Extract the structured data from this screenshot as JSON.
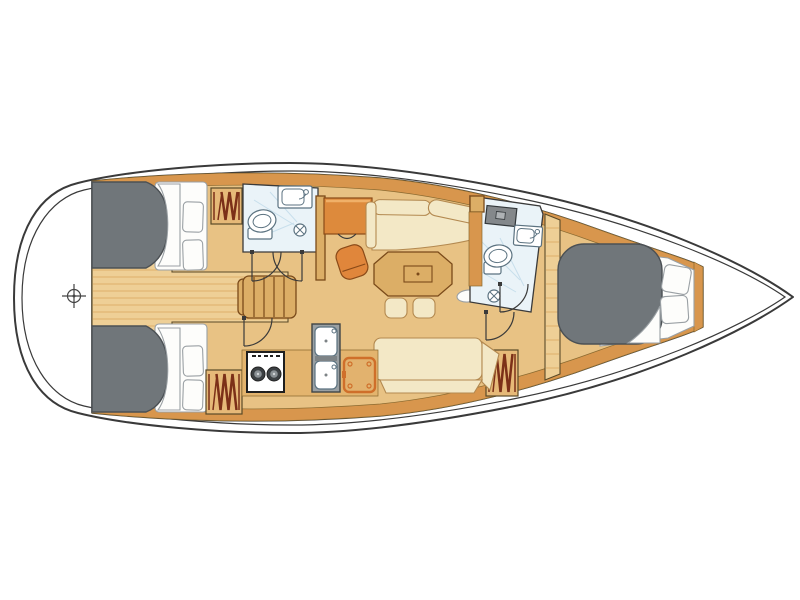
{
  "diagram": {
    "kind": "sailboat-interior-floor-plan",
    "orientation": "bow-right",
    "rooms": [
      "stern-platform",
      "aft-cabin-port",
      "aft-cabin-starboard",
      "aft-head",
      "salon",
      "galley",
      "nav-station",
      "forward-head",
      "forward-cabin"
    ]
  },
  "counts": {
    "cabins": 3,
    "heads": 2,
    "berths": 3,
    "pillows": 6,
    "hanging-lockers": 3,
    "door-swings": 5,
    "settees": 2,
    "stools": 2
  },
  "features": [
    "hull-outline",
    "hull-inner-line",
    "stern-compass-marker",
    "double-berth",
    "bed-linen",
    "pillow",
    "hanging-locker",
    "companionway-steps",
    "toilet",
    "washbasin",
    "shower-drain",
    "deck-hatch",
    "nav-desk",
    "nav-chair",
    "l-settee",
    "salon-table",
    "stool",
    "handhold-oval",
    "straight-settee",
    "stove",
    "double-sink",
    "top-loading-fridge",
    "island-berth",
    "door-swing"
  ],
  "colors": {
    "outline": "#3a3a3a",
    "hull-fill": "#ffffff",
    "trim": "#d8964d",
    "floor": "#e8c284",
    "floor-light": "#eecf96",
    "plank": "#d8a55c",
    "wood": "#dcae66",
    "wood-outline": "#7a4a1a",
    "cream": "#f3e8c6",
    "cream-outline": "#b38950",
    "orange": "#e0863b",
    "orange-deep": "#8a4a18",
    "berth-gray": "#70767a",
    "berth-outline": "#4b5054",
    "white": "#fdfdfb",
    "pillow-outline": "#9aa0a4",
    "bath": "#eaf3f8",
    "bath-streak": "#c8dfec",
    "fixture-outline": "#5b7280",
    "appliance-gray": "#9aa0a3",
    "hatch-gray": "#84888b",
    "burner": "#3c4043",
    "zigzag": "#7c3018",
    "fridge-orange": "#cf6f2a"
  }
}
